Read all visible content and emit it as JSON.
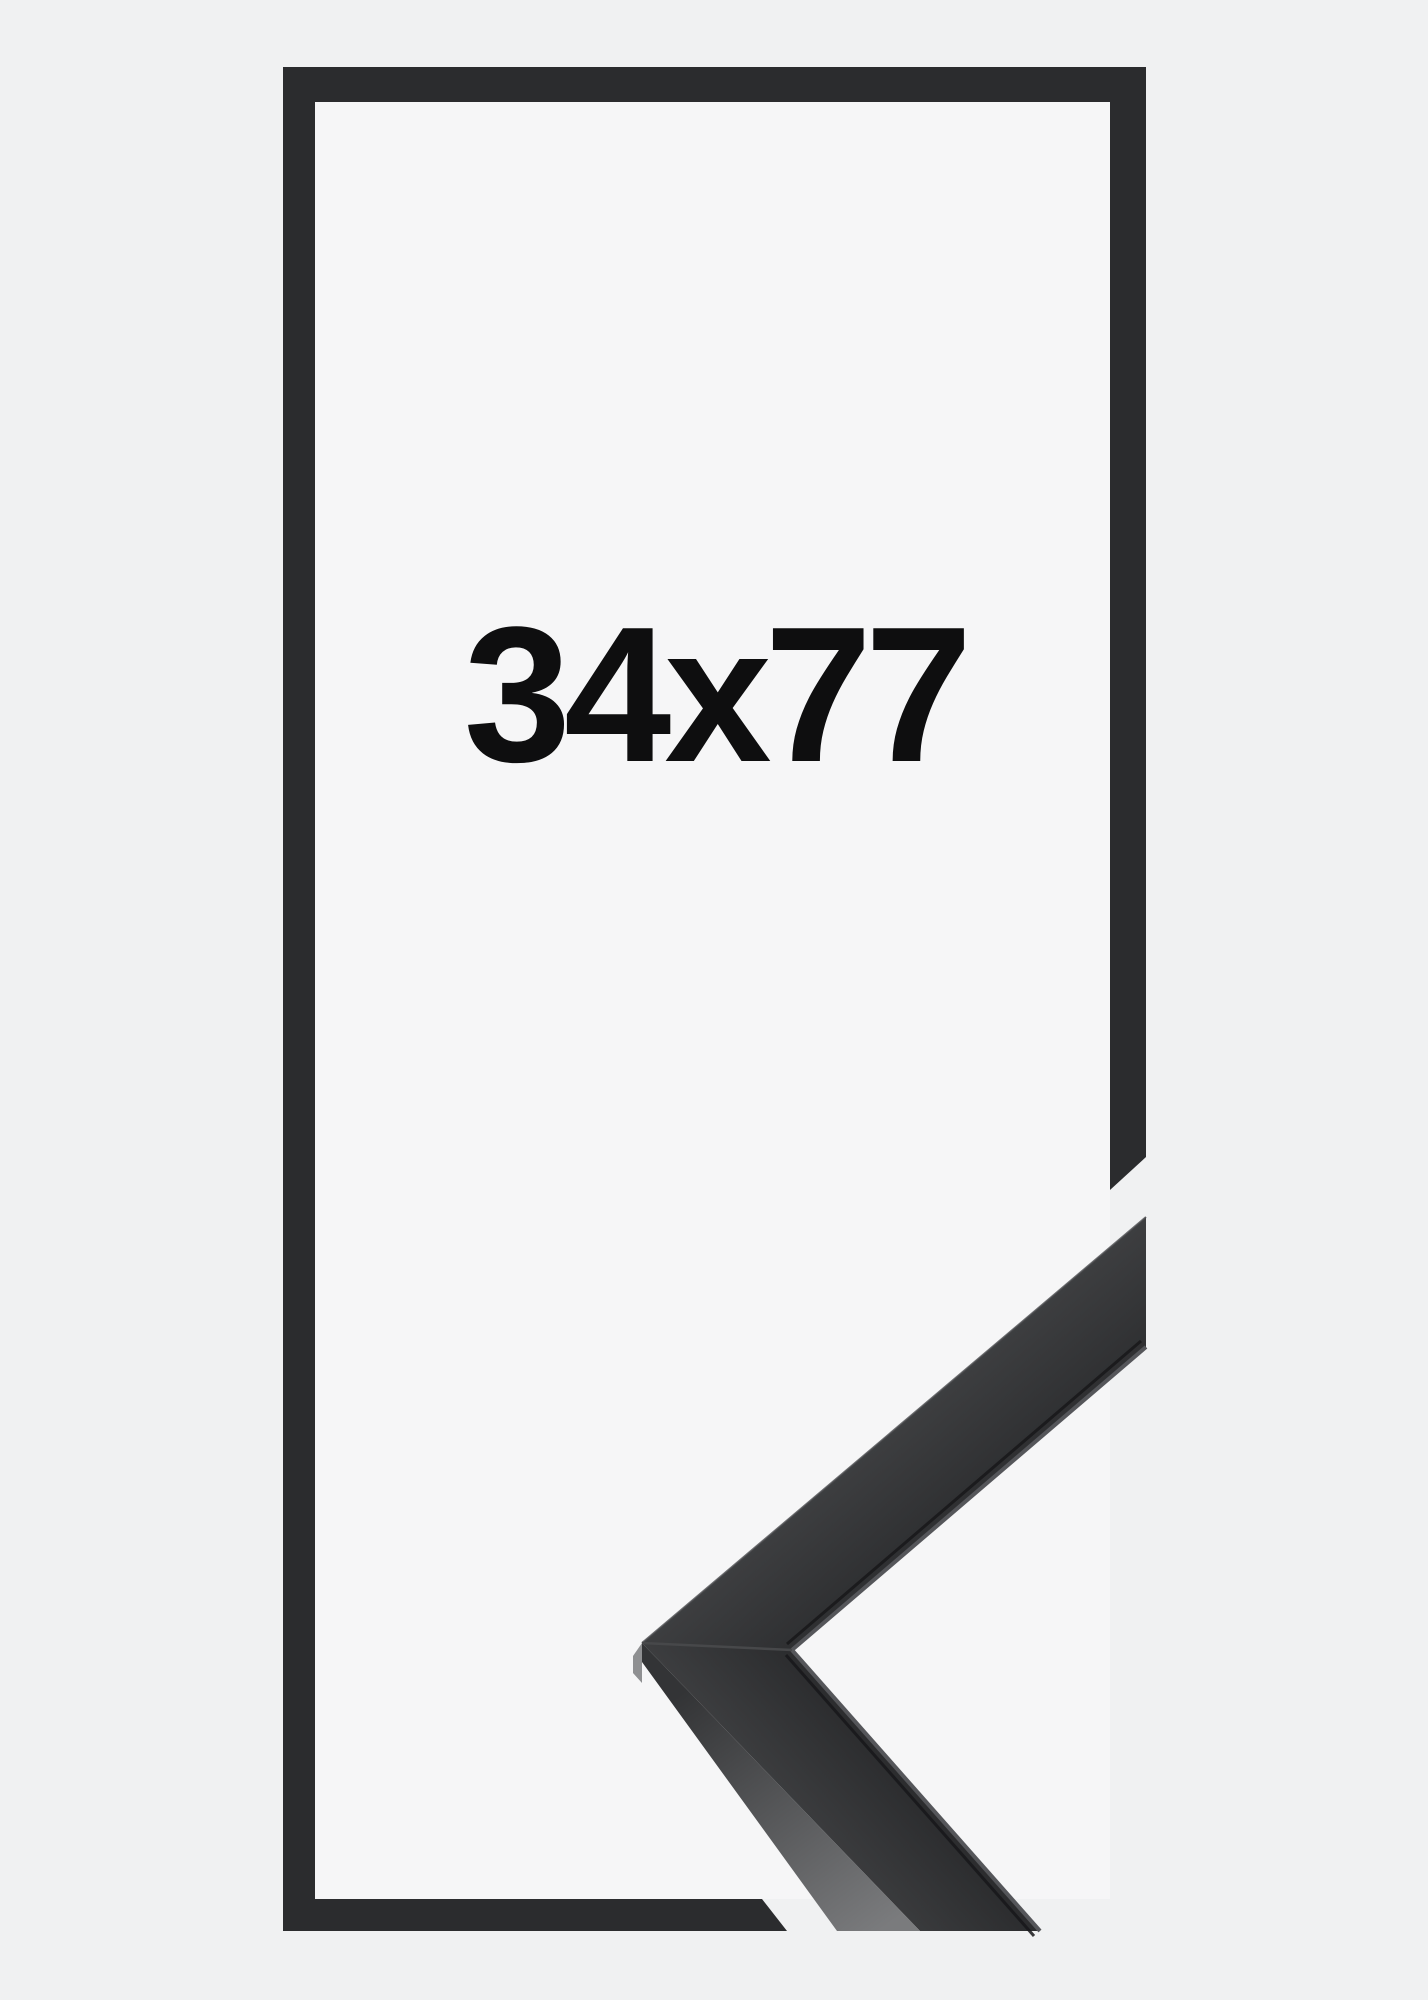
{
  "product_image": {
    "size_label": "34x77",
    "description": "black picture frame mockup with corner sample"
  },
  "colors": {
    "bg": "#f0f1f2",
    "inner-bg": "#f6f6f7",
    "frame": "#2b2c2e",
    "label": "#0e0e0f",
    "corner-light": "#3d3e40",
    "corner-dark": "#2a2b2d",
    "side-light": "#7a7b7d",
    "side-dark": "#333436",
    "lip": "#55565a",
    "crease": "#17181a",
    "seam": "#47484a",
    "rim": "#4a4b4d",
    "miter": "#8f9092"
  }
}
